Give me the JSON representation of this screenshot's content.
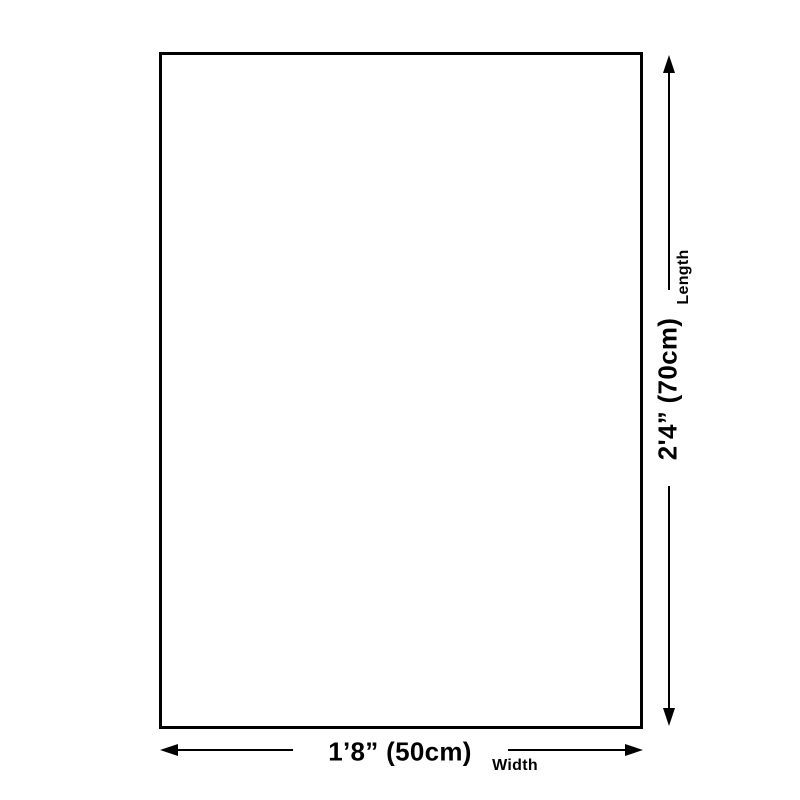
{
  "diagram": {
    "background_color": "#ffffff",
    "line_color": "#000000",
    "vertical_dimension": {
      "value_label": "2'4” (70cm)",
      "axis_label": "Length"
    },
    "horizontal_dimension": {
      "value_label": "1’8” (50cm)",
      "axis_label": "Width"
    }
  }
}
